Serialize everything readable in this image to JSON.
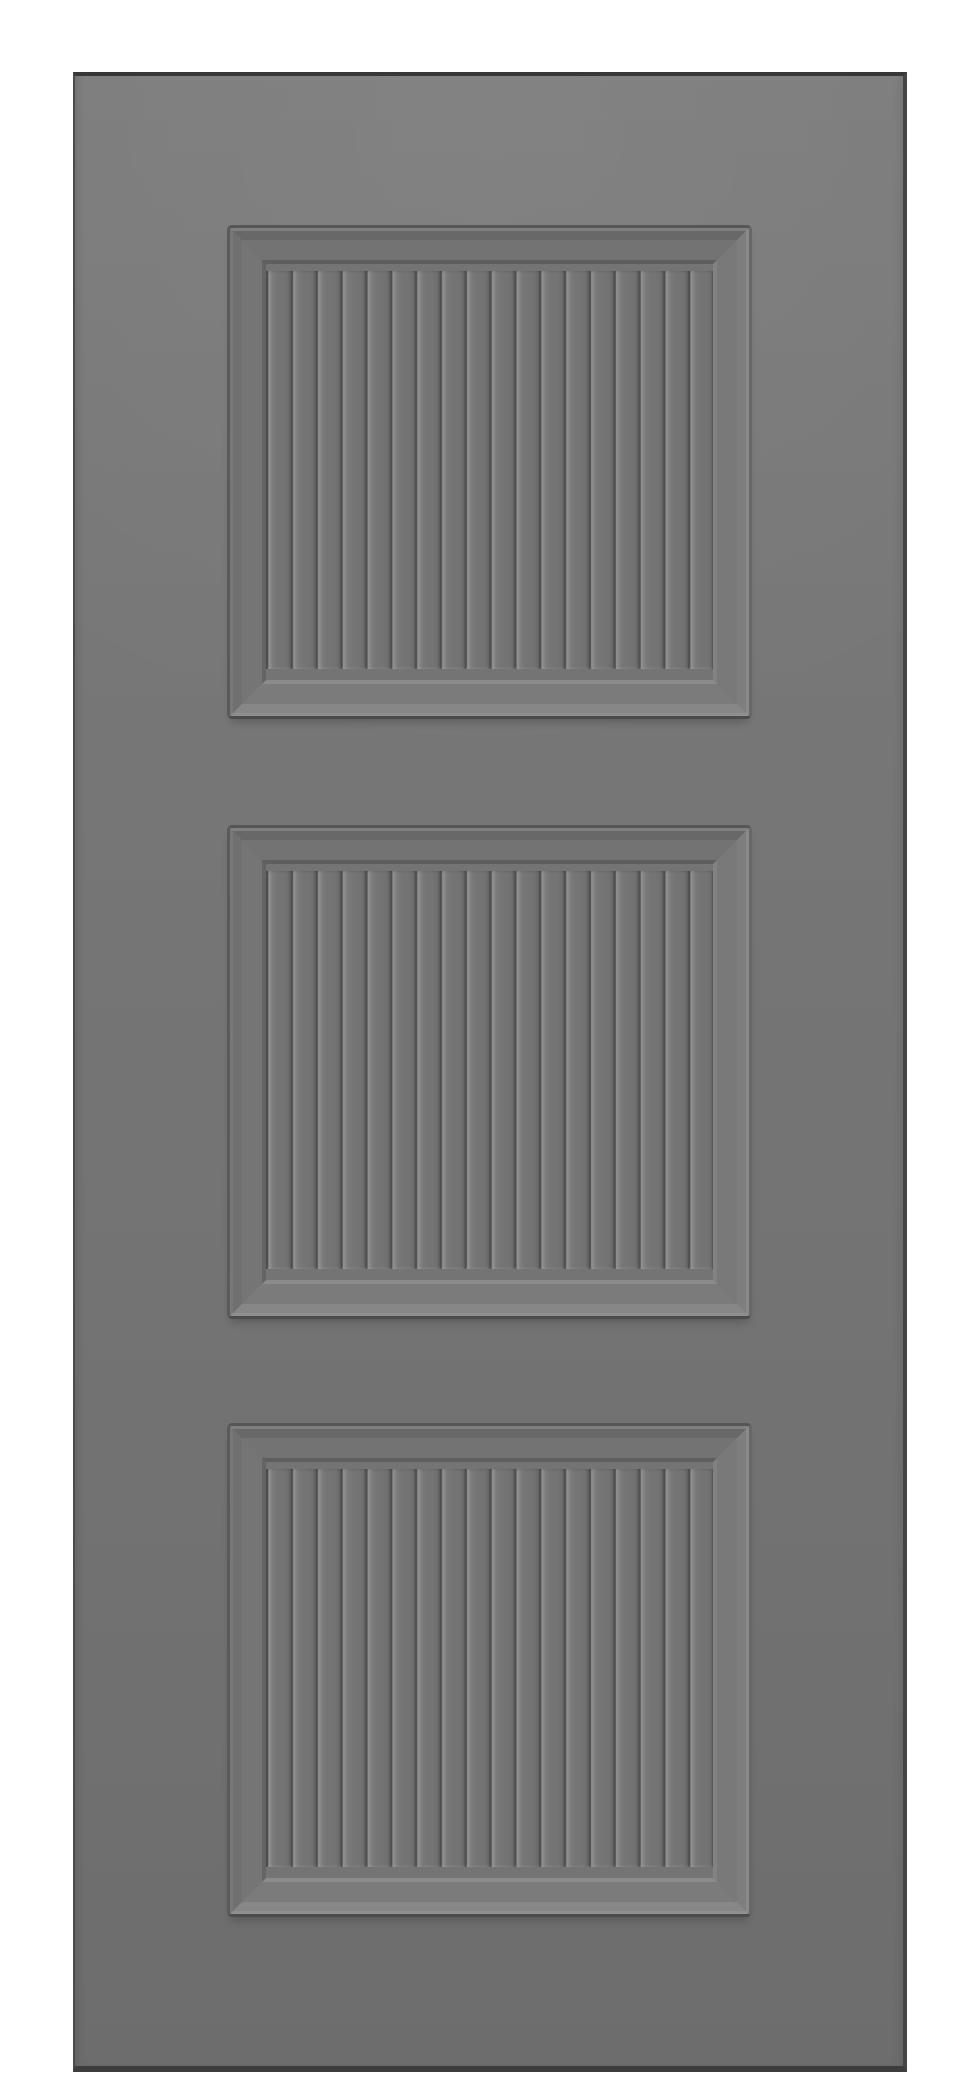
{
  "scene": {
    "type": "product-render",
    "object": "gray three-panel beadboard interior door, front view, no hardware, no text",
    "background_color": "#ffffff"
  },
  "door": {
    "x": 73,
    "y": 72,
    "width": 834,
    "height": 2000,
    "surface_top_color": "#7c7c7c",
    "surface_bottom_color": "#6d6d6d",
    "edge_top_color": "#373737",
    "edge_right_color": "#454545",
    "edge_bottom_color": "#3d3d3d",
    "edge_left_color": "#4b4b4b"
  },
  "panels": {
    "count": 3,
    "left": 152,
    "width": 525,
    "height": 494,
    "tops": [
      149,
      749,
      1347
    ],
    "slat_count": 18,
    "slat_pitch_px": 24.83,
    "frame": {
      "crease_top": "#565656",
      "crease_right": "#676767",
      "crease_bottom": "#4c4c4c",
      "crease_left": "#5a5a5a",
      "bevel_hi_top": "#7f7f7f",
      "bevel_hi_right": "#8a8a8a",
      "bevel_hi_bottom": "#8f8f8f",
      "bevel_hi_left": "#787878",
      "slope_top": "#686868",
      "slope_right": "#7e7e7e",
      "slope_bottom": "#878787",
      "slope_left": "#707070",
      "margin_top": "#737373",
      "margin_right": "#797979",
      "margin_bottom": "#7b7b7b",
      "margin_left": "#757575",
      "step_top": "#5e5e5e",
      "step_right": "#828282",
      "step_bottom": "#8b8b8b",
      "step_left": "#646464"
    },
    "slats": {
      "slat_face_color": "#757575",
      "groove_dark_color": "#505050",
      "groove_highlight_color": "#929292",
      "end_margin_color": "#747474"
    }
  }
}
